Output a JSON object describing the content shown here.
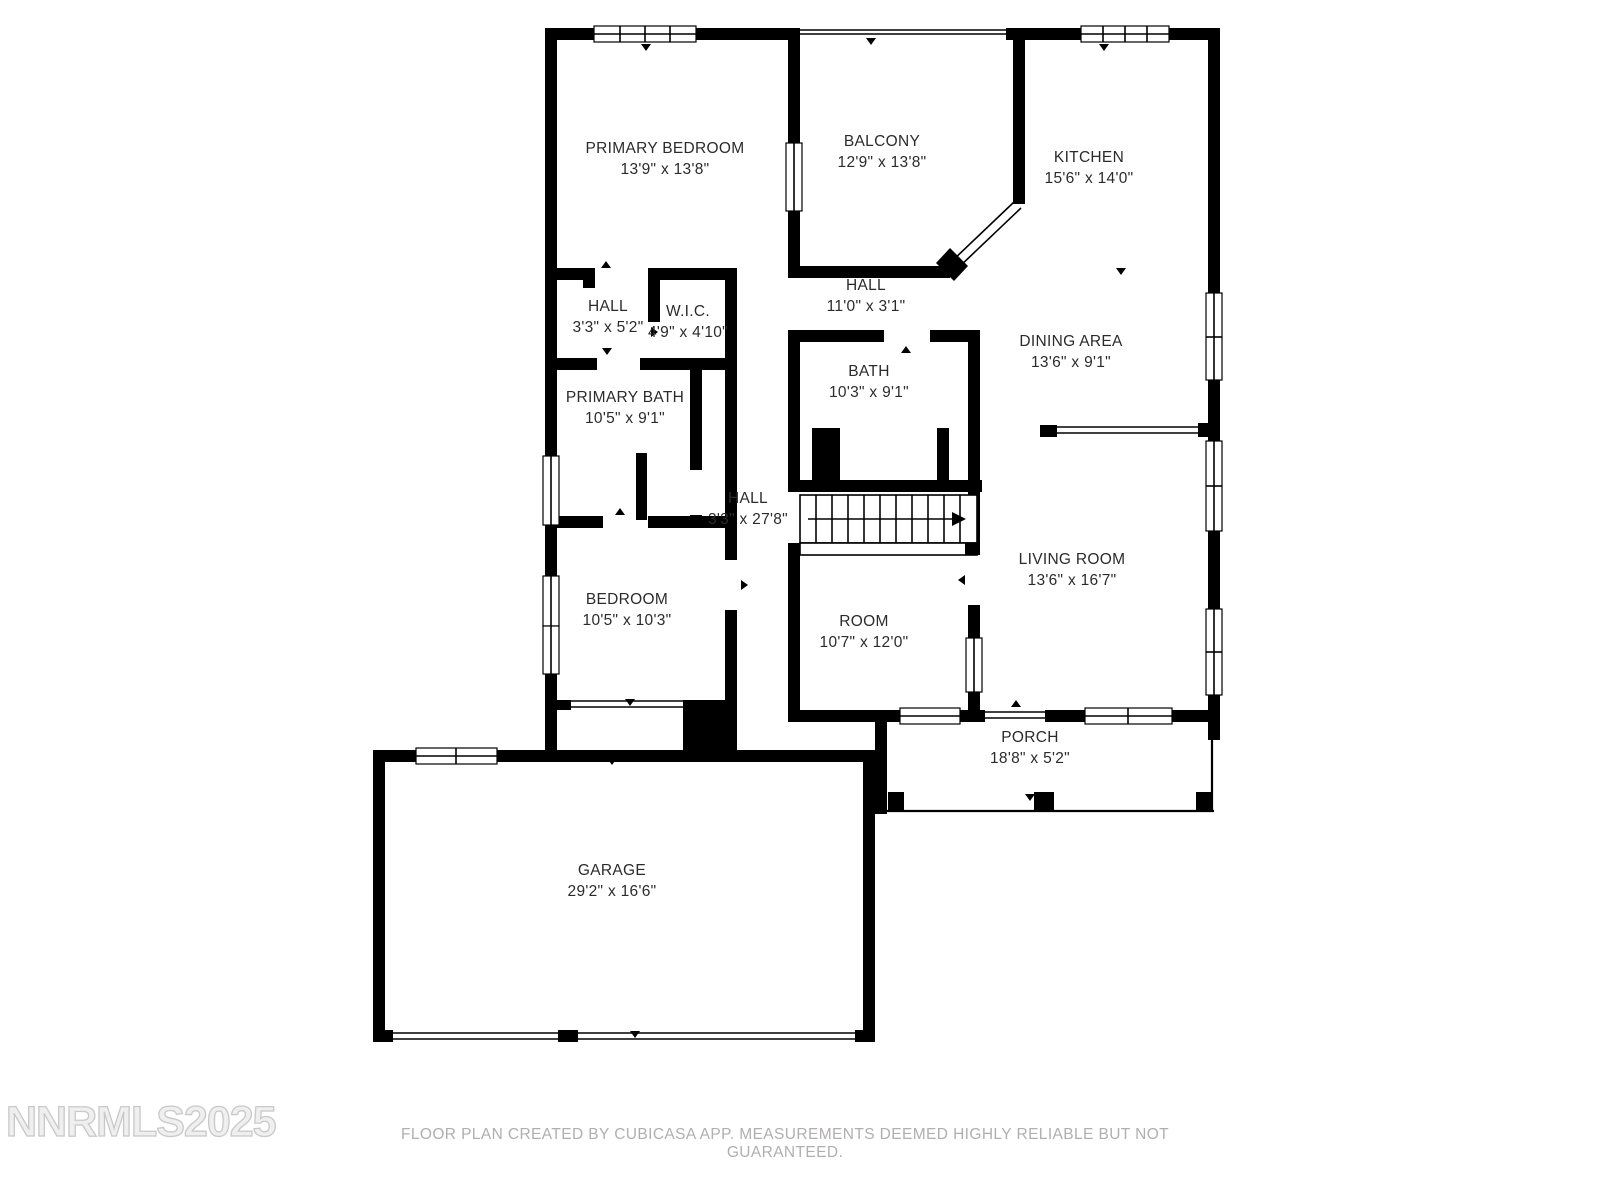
{
  "plan": {
    "rooms": [
      {
        "id": "primary_bedroom",
        "name": "PRIMARY BEDROOM",
        "dims": "13'9\" x 13'8\""
      },
      {
        "id": "balcony",
        "name": "BALCONY",
        "dims": "12'9\" x 13'8\""
      },
      {
        "id": "kitchen",
        "name": "KITCHEN",
        "dims": "15'6\" x 14'0\""
      },
      {
        "id": "hall_upper",
        "name": "HALL",
        "dims": "11'0\" x 3'1\""
      },
      {
        "id": "hall_left",
        "name": "HALL",
        "dims": "3'3\" x 5'2\""
      },
      {
        "id": "wic",
        "name": "W.I.C.",
        "dims": "4'9\" x 4'10\""
      },
      {
        "id": "dining",
        "name": "DINING AREA",
        "dims": "13'6\" x 9'1\""
      },
      {
        "id": "bath",
        "name": "BATH",
        "dims": "10'3\" x 9'1\""
      },
      {
        "id": "primary_bath",
        "name": "PRIMARY BATH",
        "dims": "10'5\" x 9'1\""
      },
      {
        "id": "hall_center",
        "name": "HALL",
        "dims": "3'3\" x 27'8\""
      },
      {
        "id": "living",
        "name": "LIVING ROOM",
        "dims": "13'6\" x 16'7\""
      },
      {
        "id": "bedroom",
        "name": "BEDROOM",
        "dims": "10'5\" x 10'3\""
      },
      {
        "id": "room",
        "name": "ROOM",
        "dims": "10'7\" x 12'0\""
      },
      {
        "id": "porch",
        "name": "PORCH",
        "dims": "18'8\" x 5'2\""
      },
      {
        "id": "garage",
        "name": "GARAGE",
        "dims": "29'2\" x 16'6\""
      }
    ],
    "watermark": "NNRMLS2025",
    "footer": "FLOOR PLAN CREATED BY CUBICASA APP. MEASUREMENTS DEEMED HIGHLY RELIABLE BUT NOT GUARANTEED.",
    "colors": {
      "wall": "#000000",
      "label": "#2b2b2b",
      "footer": "#b1aeae",
      "watermark": "#c9c9c9",
      "background": "#ffffff"
    }
  }
}
